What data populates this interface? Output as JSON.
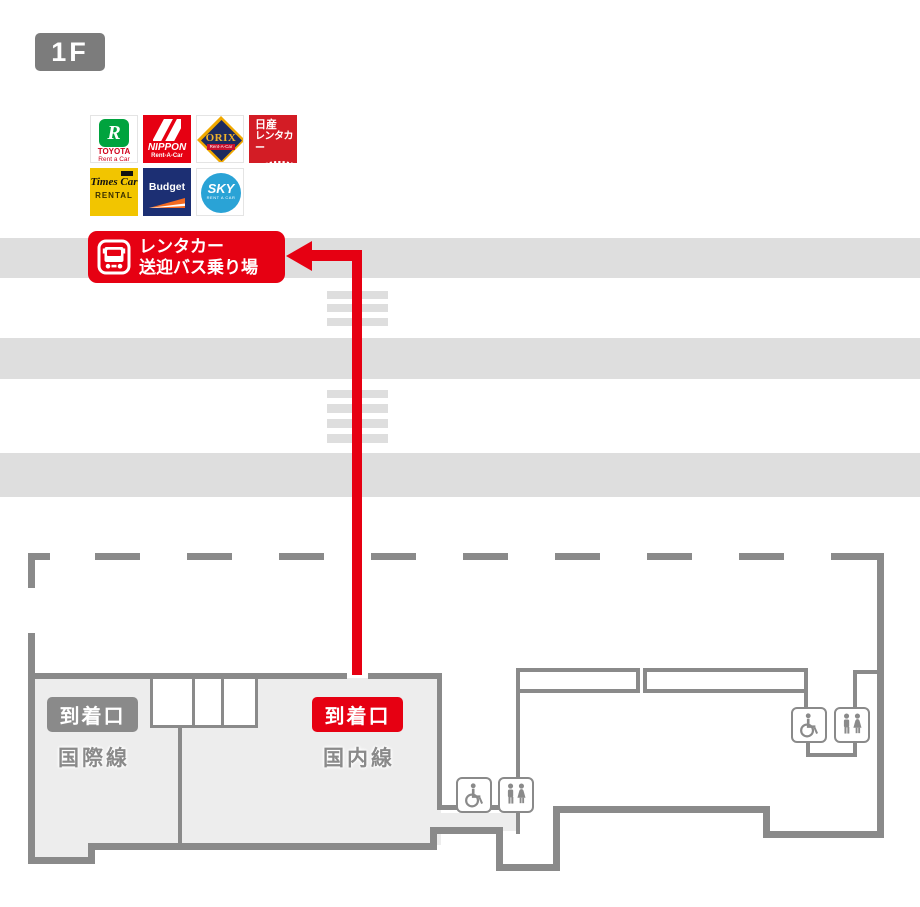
{
  "floor_badge": {
    "label": "1F"
  },
  "shuttle_banner": {
    "line1": "レンタカー",
    "line2": "送迎バス乗り場"
  },
  "rental_companies": {
    "toyota": {
      "name": "TOYOTA",
      "sub": "Rent a Car",
      "mark": "R"
    },
    "nippon": {
      "name": "NIPPON",
      "sub": "Rent-A-Car"
    },
    "orix": {
      "name": "ORIX",
      "sub": "Rent-A-Car"
    },
    "nissan": {
      "line1": "日産",
      "line2": "レンタカー"
    },
    "times": {
      "line1": "Times Car",
      "sub": "RENTAL"
    },
    "budget": {
      "name": "Budget"
    },
    "sky": {
      "name": "SKY",
      "sub": "RENT A CAR"
    }
  },
  "terminal_map": {
    "international": {
      "gate": "到着口",
      "line": "国際線"
    },
    "domestic": {
      "gate": "到着口",
      "line": "国内線"
    }
  },
  "colors": {
    "accent_red": "#e60012",
    "road_gray": "#dedede",
    "wall_gray": "#8a8a8a",
    "building_gray": "#ededed",
    "floor_badge_gray": "#7c7c7c"
  }
}
